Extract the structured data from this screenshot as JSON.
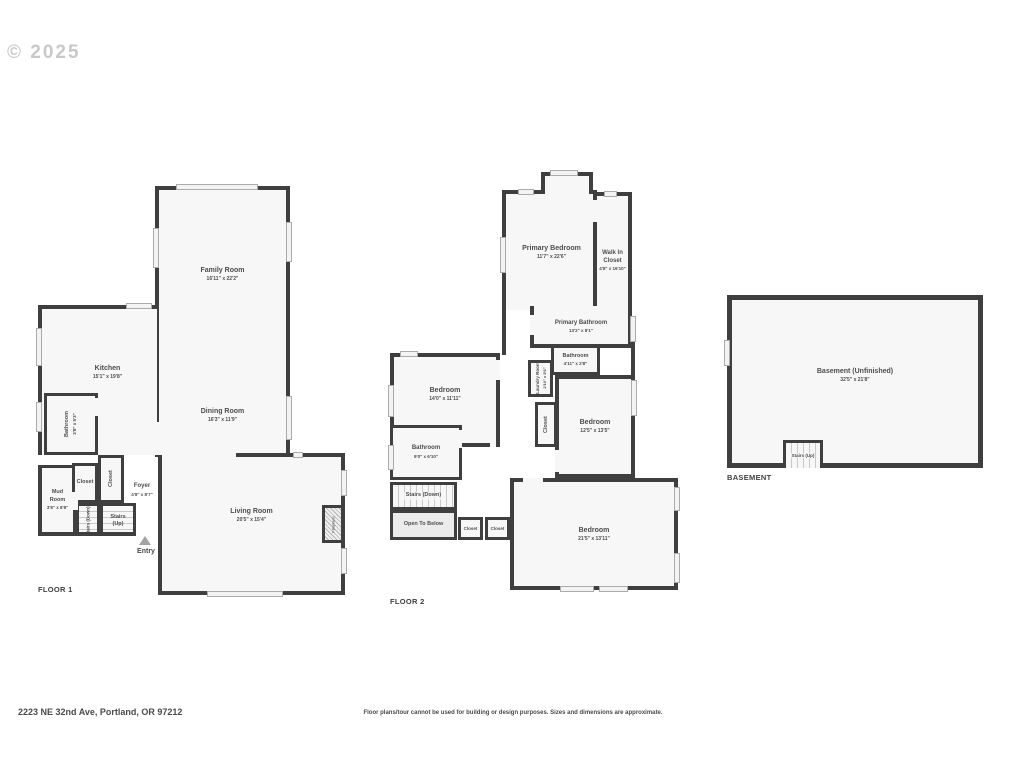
{
  "watermark": "© 2025",
  "colors": {
    "wall": "#3f3f3f",
    "room_fill": "#f7f7f7",
    "open_below_fill": "#ececec",
    "text": "#4d4d4d",
    "watermark": "#c9c9c9"
  },
  "floor1": {
    "label": "FLOOR 1",
    "entry": "Entry",
    "rooms": {
      "family": {
        "name": "Family Room",
        "dims": "16'11\" x 22'2\""
      },
      "kitchen": {
        "name": "Kitchen",
        "dims": "15'1\" x 19'8\""
      },
      "dining": {
        "name": "Dining Room",
        "dims": "16'3\" x 11'9\""
      },
      "living": {
        "name": "Living Room",
        "dims": "20'5\" x 15'4\""
      },
      "bathroom": {
        "name": "Bathroom",
        "dims": "3'8\" x 5'3\""
      },
      "mud": {
        "name": "Mud Room",
        "dims": "3'8\" x 8'8\""
      },
      "foyer": {
        "name": "Foyer",
        "dims": "4'8\" x 8'7\""
      },
      "closet_a": {
        "name": "Closet"
      },
      "closet_b": {
        "name": "Closet"
      },
      "stairs_up": {
        "name": "Stairs (Up)"
      },
      "stairs_down": {
        "name": "Stairs (Down)"
      },
      "fireplace": {
        "name": "Fireplace"
      }
    }
  },
  "floor2": {
    "label": "FLOOR 2",
    "rooms": {
      "primary_bedroom": {
        "name": "Primary Bedroom",
        "dims": "11'7\" x 22'6\""
      },
      "walk_in_closet": {
        "name": "Walk In Closet",
        "dims": "4'8\" x 16'10\""
      },
      "primary_bathroom": {
        "name": "Primary Bathroom",
        "dims": "13'2\" x 8'1\""
      },
      "bathroom_small": {
        "name": "Bathroom",
        "dims": "4'11\" x 2'8\""
      },
      "laundry": {
        "name": "Laundry Room",
        "dims": "2'10\" x 5'6\""
      },
      "closet_hall": {
        "name": "Closet"
      },
      "bedroom_left": {
        "name": "Bedroom",
        "dims": "14'0\" x 11'11\""
      },
      "bedroom_right": {
        "name": "Bedroom",
        "dims": "12'5\" x 13'5\""
      },
      "bathroom_left": {
        "name": "Bathroom",
        "dims": "9'0\" x 6'10\""
      },
      "stairs_down": {
        "name": "Stairs (Down)"
      },
      "open_to_below": {
        "name": "Open To Below"
      },
      "closet_a": {
        "name": "Closet"
      },
      "closet_b": {
        "name": "Closet"
      },
      "bedroom_bottom": {
        "name": "Bedroom",
        "dims": "21'5\" x 13'11\""
      }
    }
  },
  "basement": {
    "label": "BASEMENT",
    "rooms": {
      "main": {
        "name": "Basement (Unfinished)",
        "dims": "32'5\" x 21'8\""
      },
      "stairs_up": {
        "name": "Stairs (Up)"
      }
    }
  },
  "footer": {
    "address": "2223 NE 32nd Ave, Portland, OR 97212",
    "disclaimer": "Floor plans/tour cannot be used for building or design purposes. Sizes and dimensions are approximate."
  }
}
